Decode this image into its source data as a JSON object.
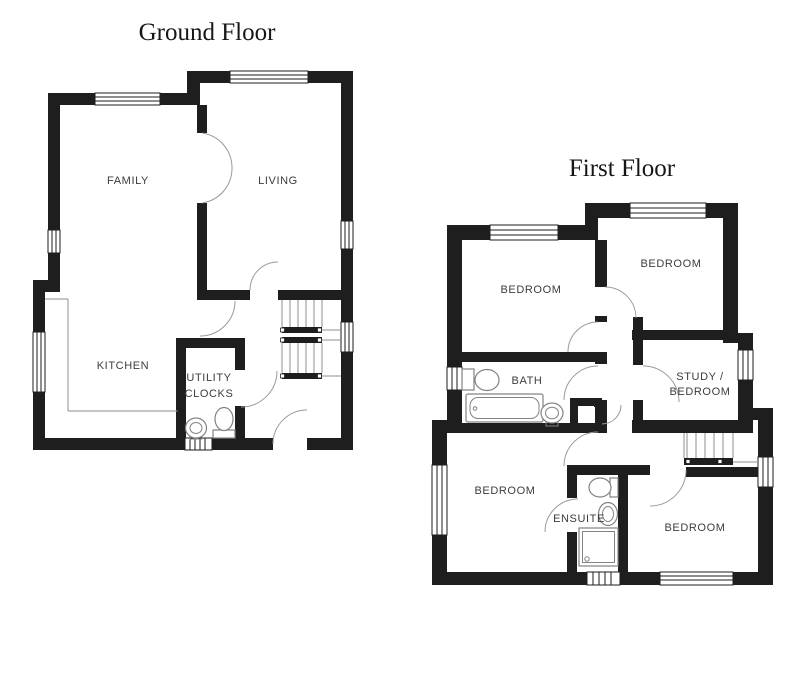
{
  "ground_floor": {
    "title": "Ground Floor",
    "rooms": {
      "family": "FAMILY",
      "living": "LIVING",
      "kitchen": "KITCHEN",
      "utility_line1": "UTILITY",
      "utility_line2": "CLOCKS"
    }
  },
  "first_floor": {
    "title": "First Floor",
    "rooms": {
      "bedroom_nw": "BEDROOM",
      "bedroom_ne": "BEDROOM",
      "bath": "BATH",
      "study_line1": "STUDY /",
      "study_line2": "BEDROOM",
      "bedroom_sw": "BEDROOM",
      "ensuite": "ENSUITE",
      "bedroom_se": "BEDROOM"
    }
  },
  "colors": {
    "wall": "#1e1e1e",
    "thin_line": "#8f8f8f",
    "label": "#3c3c3c",
    "background": "#ffffff"
  }
}
